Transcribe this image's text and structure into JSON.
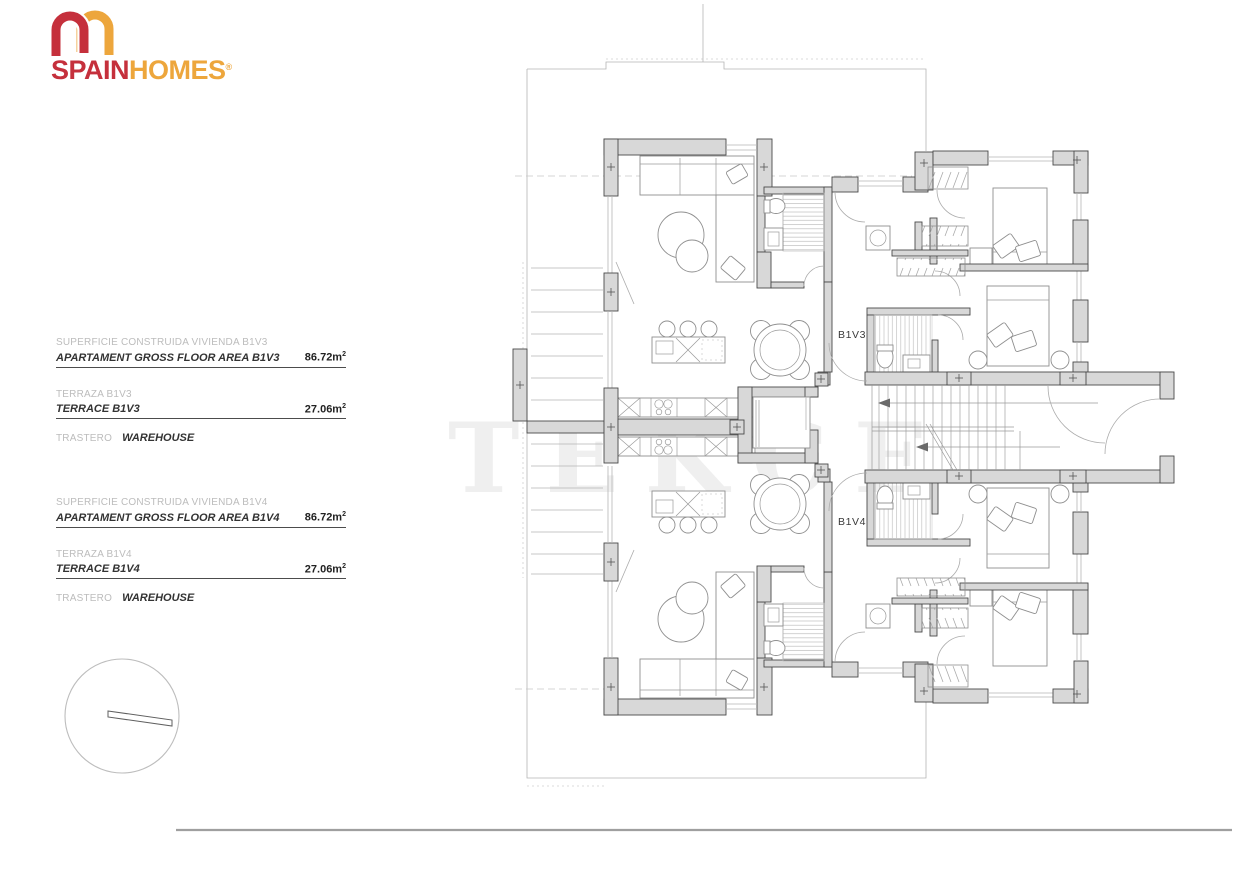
{
  "brand": {
    "word1": "SPAIN",
    "word2": "HOMES",
    "registered": "®"
  },
  "colors": {
    "brand_red": "#c5303c",
    "brand_gold": "#eda63c",
    "wall_gray": "#d8d8d8",
    "text_gray": "#bcbcbc",
    "text_dark": "#333333"
  },
  "areas": {
    "b1v3": {
      "construida_es": "SUPERFICIE CONSTRUIDA VIVIENDA B1V3",
      "construida_en": "APARTAMENT GROSS FLOOR AREA B1V3",
      "construida_value": "86.72m",
      "construida_sup": "2",
      "terraza_es": "TERRAZA B1V3",
      "terraza_en": "TERRACE B1V3",
      "terraza_value": "27.06m",
      "terraza_sup": "2",
      "trastero_es": "TRASTERO",
      "trastero_en": "WAREHOUSE"
    },
    "b1v4": {
      "construida_es": "SUPERFICIE CONSTRUIDA VIVIENDA B1V4",
      "construida_en": "APARTAMENT GROSS FLOOR AREA B1V4",
      "construida_value": "86.72m",
      "construida_sup": "2",
      "terraza_es": "TERRAZA B1V4",
      "terraza_en": "TERRACE B1V4",
      "terraza_value": "27.06m",
      "terraza_sup": "2",
      "trastero_es": "TRASTERO",
      "trastero_en": "WAREHOUSE"
    }
  },
  "plan": {
    "unit_top_label": "B1V3",
    "unit_bottom_label": "B1V4",
    "watermark": "TEKCE"
  }
}
